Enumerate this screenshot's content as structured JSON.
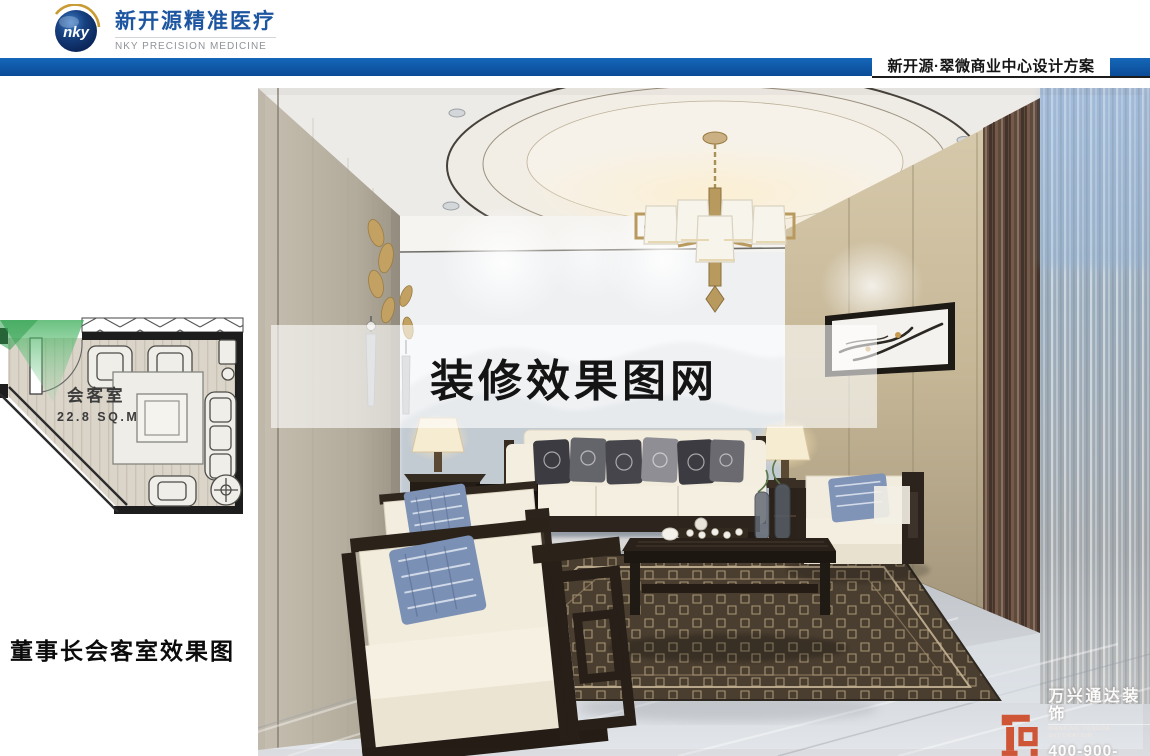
{
  "header": {
    "logo": {
      "abbr": "nky",
      "company_cn": "新开源精准医疗",
      "company_en": "NKY PRECISION MEDICINE"
    },
    "project_title": "新开源·翠微商业中心设计方案"
  },
  "plan": {
    "room_label": "会客室",
    "area_label": "22.8 SQ.M",
    "caption": "董事长会客室效果图"
  },
  "watermark": {
    "site_text": "装修效果图网",
    "brand_cn": "万兴通达装饰",
    "brand_en": "WANXING TONGDA DECORATION",
    "brand_phone": "400-900-4560"
  },
  "colors": {
    "accent_blue": "#0f57a6",
    "logo_blue": "#1d56a0",
    "brand_orange": "#cd4b28",
    "cone_green": "#45b160"
  }
}
